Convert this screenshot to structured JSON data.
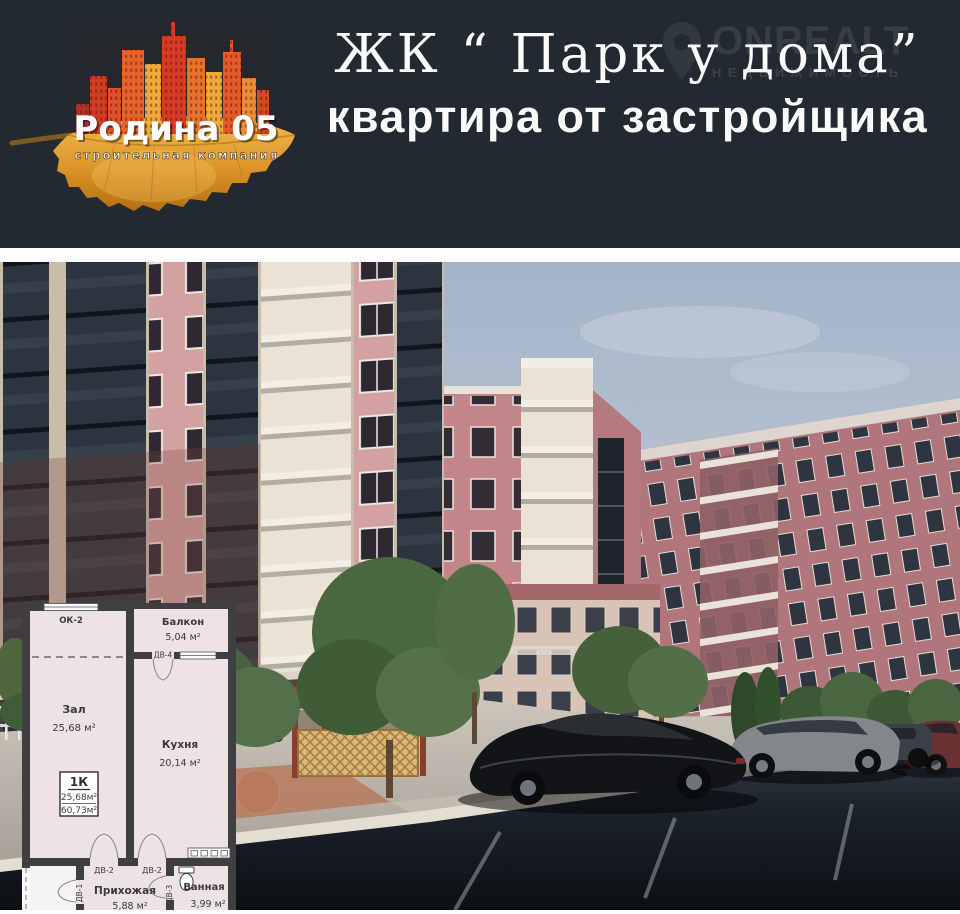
{
  "header": {
    "logo": {
      "title": "Родина 05",
      "subtitle": "строительная компания"
    },
    "title": "ЖК “ Парк у дома”",
    "subtitle": "квартира от застройщика",
    "watermark": {
      "brand": "ONREALT",
      "sub": "НЕДВИЖИМОСТЬ"
    }
  },
  "floor_plan": {
    "window_label": "ОК-2",
    "rooms": {
      "balcony": {
        "name": "Балкон",
        "area": "5,04 м²"
      },
      "living": {
        "name": "Зал",
        "area": "25,68 м²"
      },
      "kitchen": {
        "name": "Кухня",
        "area": "20,14 м²"
      },
      "hallway": {
        "name": "Прихожая",
        "area": "5,88 м²"
      },
      "bathroom": {
        "name": "Ванная",
        "area": "3,99 м²"
      }
    },
    "info_box": {
      "type": "1К",
      "living_area": "25,68м²",
      "total_area": "60,73м²"
    },
    "doors": {
      "d1": "ДВ-1",
      "d2": "ДВ-2",
      "d3": "ДВ-3",
      "d4": "ДВ-4"
    }
  },
  "palette": {
    "header_bg": "#222930",
    "leaf_gold": "#d99a2b",
    "city_orange": "#e8622a",
    "building_pink": "#c28589",
    "building_mauve": "#b1767b",
    "plan_floor": "#ede3e5",
    "plan_wall": "#3f3e41",
    "sky": "#a3b4c9",
    "road": "#14181e",
    "text_white": "#ffffff"
  }
}
